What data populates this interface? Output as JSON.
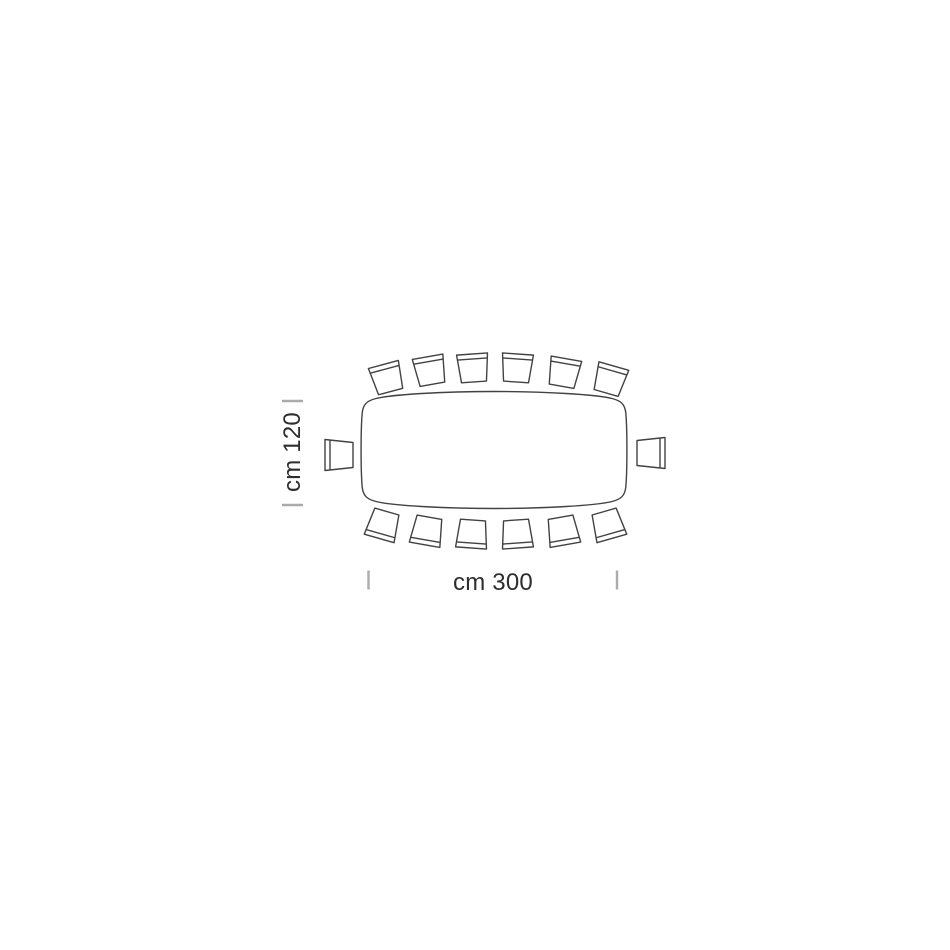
{
  "page": {
    "background": "#ffffff"
  },
  "diagram": {
    "kind": "table-seating-dimension-diagram-top-view",
    "table": {
      "shape": "rounded-barrel-rectangle",
      "width_cm": 300,
      "depth_cm": 120
    },
    "seats": {
      "total": 14,
      "top": 6,
      "bottom": 6,
      "left": 1,
      "right": 1
    },
    "chairs": [
      {
        "side": "top",
        "x": 387,
        "y": 378,
        "r": -15
      },
      {
        "side": "top",
        "x": 430,
        "y": 370.5,
        "r": -10
      },
      {
        "side": "top",
        "x": 473,
        "y": 368,
        "r": -4
      },
      {
        "side": "top",
        "x": 517,
        "y": 368,
        "r": 4
      },
      {
        "side": "top",
        "x": 564,
        "y": 372.5,
        "r": 10
      },
      {
        "side": "top",
        "x": 610,
        "y": 379.5,
        "r": 16
      },
      {
        "side": "bottom",
        "x": 383,
        "y": 525,
        "r": 196
      },
      {
        "side": "bottom",
        "x": 427,
        "y": 531,
        "r": 190
      },
      {
        "side": "bottom",
        "x": 472,
        "y": 534,
        "r": 184
      },
      {
        "side": "bottom",
        "x": 517,
        "y": 534,
        "r": 176
      },
      {
        "side": "bottom",
        "x": 563,
        "y": 531,
        "r": 170
      },
      {
        "side": "bottom",
        "x": 608,
        "y": 525,
        "r": 164
      },
      {
        "side": "left",
        "x": 339,
        "y": 455,
        "r": -90
      },
      {
        "side": "right",
        "x": 651,
        "y": 453,
        "r": 90
      }
    ],
    "dimensions": {
      "depth": {
        "label": "cm 120",
        "value": 120,
        "unit": "cm"
      },
      "width": {
        "label": "cm 300",
        "value": 300,
        "unit": "cm"
      }
    },
    "colors": {
      "line": "#424242",
      "tick": "#ababab",
      "text": "#2d2d2d",
      "background": "#ffffff"
    }
  }
}
